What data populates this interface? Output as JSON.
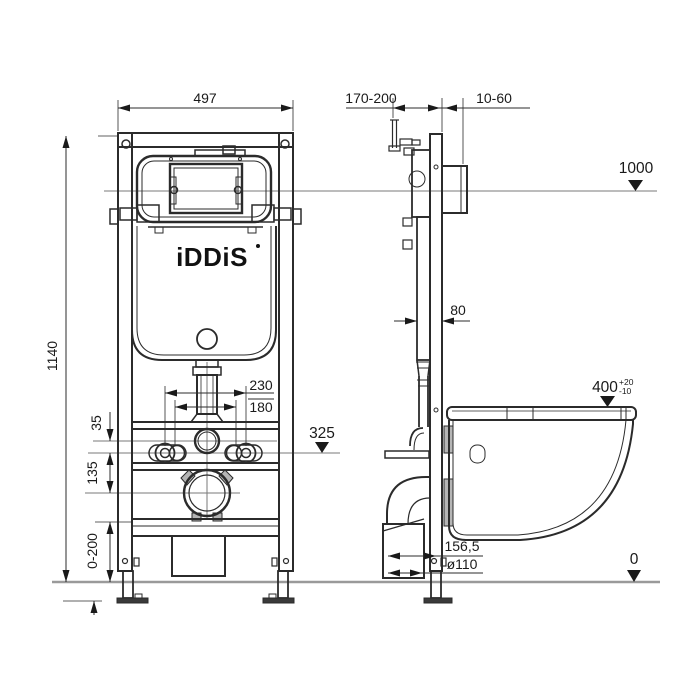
{
  "brand": {
    "name": "iDDiS"
  },
  "front_view": {
    "frame_width": "497",
    "frame_height": "1140",
    "bolt_spacing_outer": "230",
    "bolt_spacing_inner": "180",
    "rail_to_bolt_axis": "35",
    "bolt_axis_to_drain": "135",
    "bolt_axis_level": "325",
    "leg_adjust_range": "0-200"
  },
  "side_view": {
    "inlet_depth_range": "170-200",
    "wall_clearance_range": "10-60",
    "top_level": "1000",
    "frame_depth": "80",
    "bowl_height": "400",
    "bowl_height_tol_plus": "+20",
    "bowl_height_tol_minus": "-10",
    "outlet_offset": "156,5",
    "outlet_diameter": "ø110",
    "floor_level": "0"
  }
}
